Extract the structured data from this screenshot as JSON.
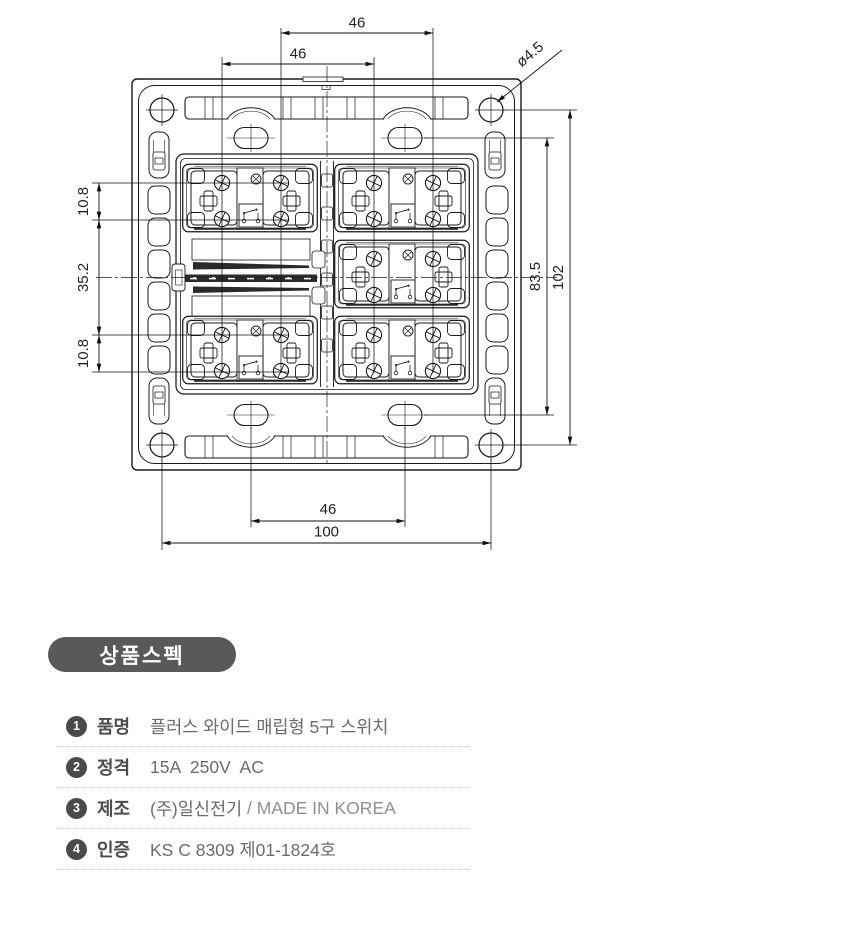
{
  "drawing": {
    "dims": {
      "top_outer": "46",
      "top_inner": "46",
      "hole_dia": "ø4.5",
      "left_top": "10.8",
      "left_mid": "35.2",
      "left_bottom": "10.8",
      "right_inner": "83.5",
      "right_outer": "102",
      "bottom_inner": "46",
      "bottom_outer": "100"
    }
  },
  "spec": {
    "heading": "상품스펙",
    "rows": [
      {
        "num": "1",
        "label": "품명",
        "value": "플러스 와이드 매립형 5구 스위치",
        "value_light": ""
      },
      {
        "num": "2",
        "label": "정격",
        "value": "15A  250V  AC",
        "value_light": ""
      },
      {
        "num": "3",
        "label": "제조",
        "value": "(주)일신전기",
        "value_light": " / MADE IN KOREA"
      },
      {
        "num": "4",
        "label": "인증",
        "value": "KS C 8309 제01-1824호",
        "value_light": ""
      }
    ],
    "colors": {
      "heading_bg": "#595959",
      "badge": "#4a4a4a",
      "line_work": "#1a1a1a"
    }
  }
}
